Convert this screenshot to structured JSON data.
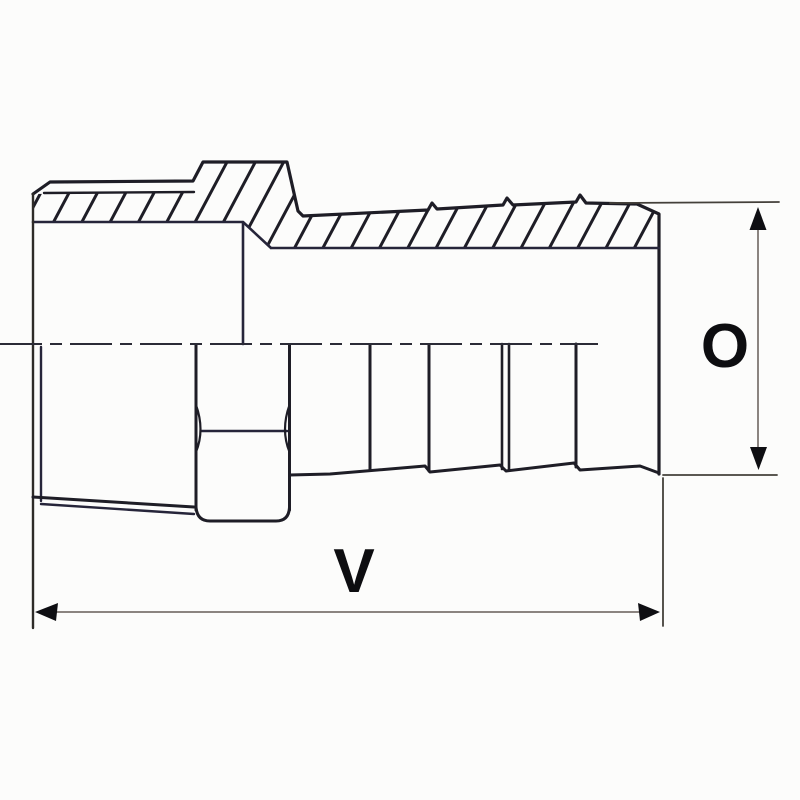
{
  "page": {
    "background_color": "#fcfcfb"
  },
  "drawing": {
    "kind": "technical-line-drawing-half-section",
    "subject": "male threaded to hose-barb adapter fitting",
    "colors": {
      "part_line": "#1e1d26",
      "inner_line": "#26253a",
      "centerline": "#2b2b36",
      "extension_line": "#44403a",
      "dimension_line": "#8b8480",
      "arrowhead": "#0e0e12",
      "label": "#0d0d10"
    },
    "labels": {
      "length_dimension": "V",
      "diameter_dimension": "O"
    },
    "dimensions": [
      {
        "label": "V",
        "orientation": "horizontal",
        "location": "bottom",
        "spans": "overall fitting length"
      },
      {
        "label": "O",
        "orientation": "vertical",
        "location": "right",
        "spans": "barb end outside diameter"
      }
    ]
  }
}
